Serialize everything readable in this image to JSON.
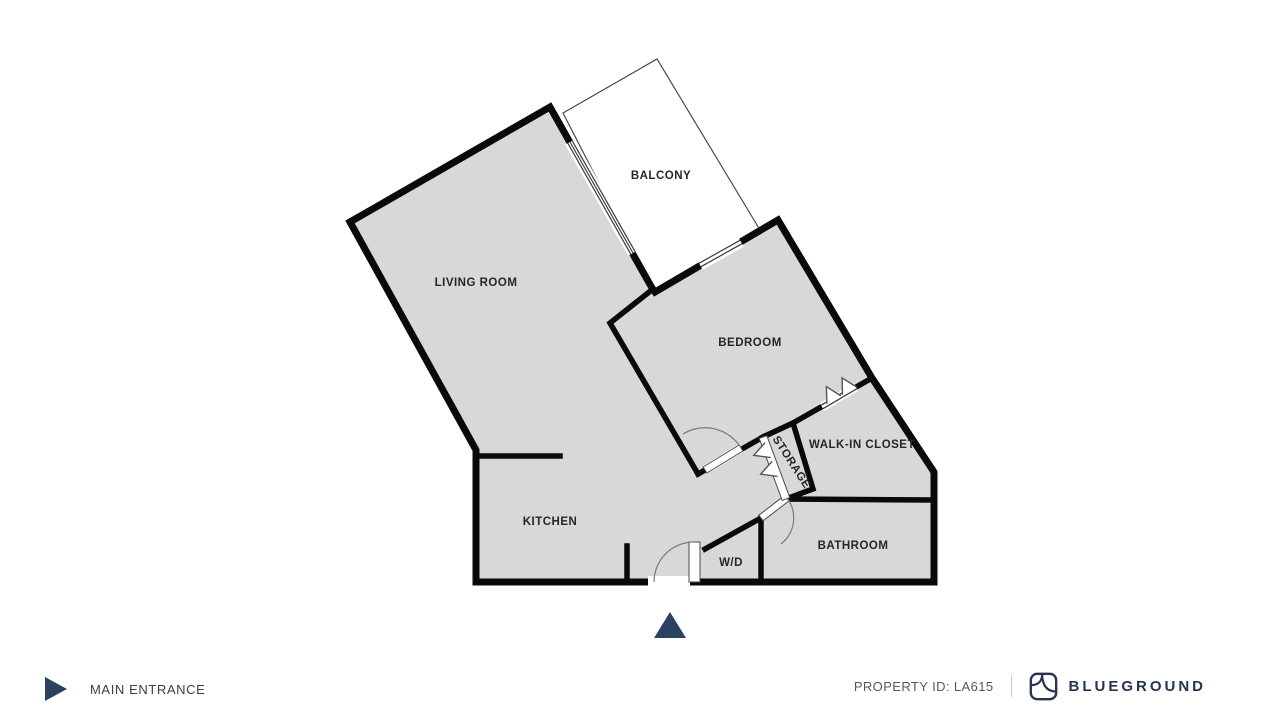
{
  "floorplan": {
    "rooms": {
      "living_room": "LIVING ROOM",
      "balcony": "BALCONY",
      "bedroom": "BEDROOM",
      "walk_in_closet": "WALK-IN CLOSET",
      "storage": "STORAGE",
      "kitchen": "KITCHEN",
      "washer_dryer": "W/D",
      "bathroom": "BATHROOM"
    }
  },
  "legend": {
    "main_entrance_label": "MAIN ENTRANCE"
  },
  "footer": {
    "property_id_label": "PROPERTY ID: LA615",
    "brand_name": "BLUEGROUND"
  },
  "colors": {
    "wall": "#0a0a0a",
    "room_fill": "#d8d8d8",
    "navy": "#2c4161",
    "brand_navy": "#253450",
    "label_text": "#262626",
    "muted_text": "#55595f",
    "divider": "#c8cbd0",
    "thin_line": "#3c3c3c"
  }
}
